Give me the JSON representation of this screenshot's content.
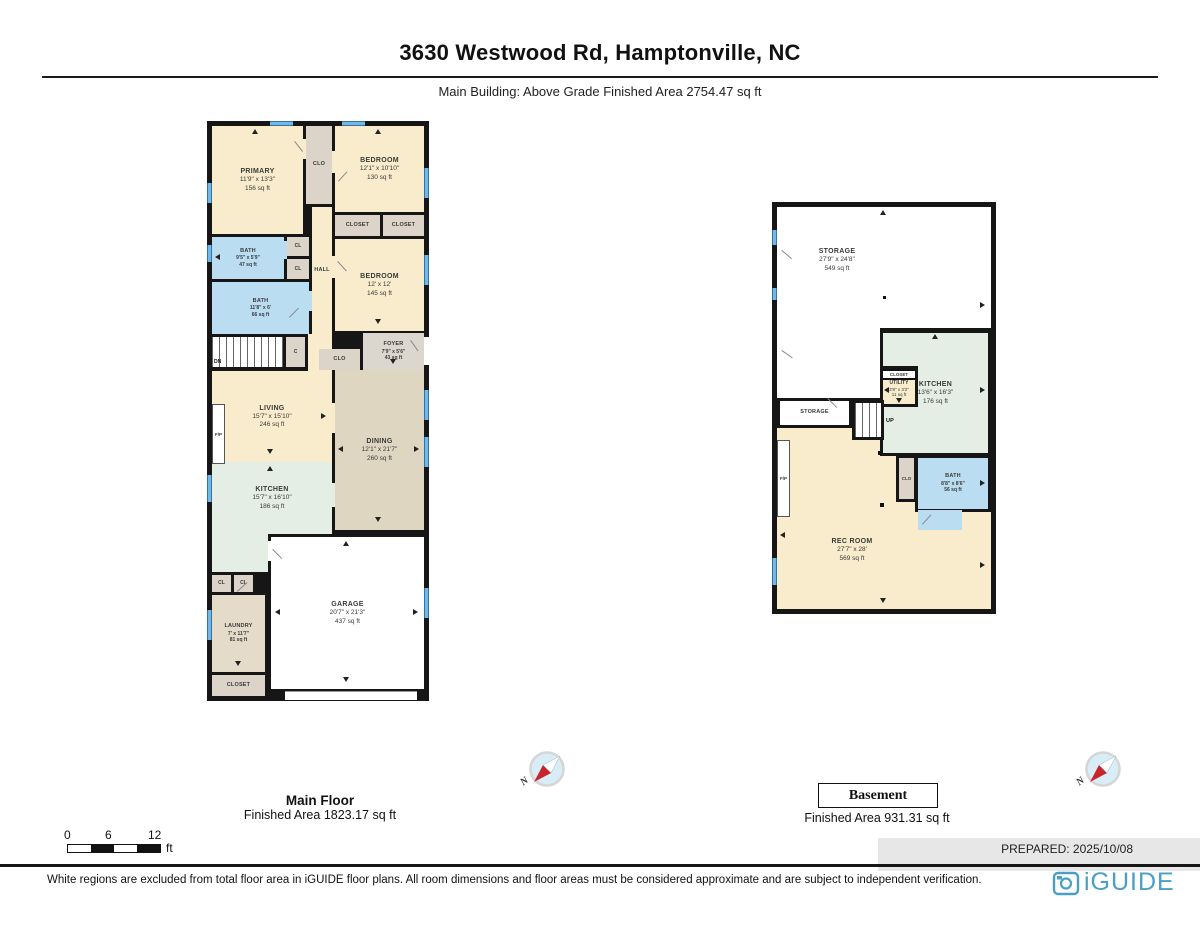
{
  "page": {
    "title": "3630 Westwood Rd, Hamptonville, NC",
    "subtitle": "Main Building: Above Grade Finished Area 2754.47 sq ft",
    "prepared": "PREPARED: 2025/10/08",
    "disclaimer": "White regions are excluded from total floor area in iGUIDE floor plans. All room dimensions and floor areas must be considered approximate and are subject to independent verification.",
    "brand": "iGUIDE"
  },
  "scale_bar": {
    "start": "0",
    "mid": "6",
    "end": "12",
    "unit": "ft"
  },
  "compass": {
    "north": "N"
  },
  "main_floor": {
    "title": "Main Floor",
    "area": "Finished Area 1823.17 sq ft",
    "rooms": {
      "primary": {
        "name": "PRIMARY",
        "dims": "11'9\" x 13'3\"",
        "area": "156 sq ft"
      },
      "clo_top": {
        "name": "CLO"
      },
      "bedroom1": {
        "name": "BEDROOM",
        "dims": "12'1\" x 10'10\"",
        "area": "130 sq ft"
      },
      "closet_left": {
        "name": "CLOSET"
      },
      "closet_right": {
        "name": "CLOSET"
      },
      "bath1": {
        "name": "BATH",
        "dims": "9'5\" x 5'9\"",
        "area": "47 sq ft"
      },
      "cl_a": {
        "name": "CL"
      },
      "cl_b": {
        "name": "CL"
      },
      "bath2": {
        "name": "BATH",
        "dims": "11'8\" x 6'",
        "area": "66 sq ft"
      },
      "hall": {
        "name": "HALL"
      },
      "bedroom2": {
        "name": "BEDROOM",
        "dims": "12' x 12'",
        "area": "145 sq ft"
      },
      "stairs": {
        "label": "DN"
      },
      "c_closet": {
        "name": "C"
      },
      "clo2": {
        "name": "CLO"
      },
      "foyer": {
        "name": "FOYER",
        "dims": "7'9\" x 5'6\"",
        "area": "43 sq ft"
      },
      "living": {
        "name": "LIVING",
        "dims": "15'7\" x 15'10\"",
        "area": "246 sq ft"
      },
      "fireplace": {
        "name": "F/P"
      },
      "dining": {
        "name": "DINING",
        "dims": "12'1\" x 21'7\"",
        "area": "260 sq ft"
      },
      "kitchen": {
        "name": "KITCHEN",
        "dims": "15'7\" x 16'10\"",
        "area": "186 sq ft"
      },
      "garage": {
        "name": "GARAGE",
        "dims": "20'7\" x 21'3\"",
        "area": "437 sq ft"
      },
      "cl_c": {
        "name": "CL"
      },
      "cl_d": {
        "name": "CL"
      },
      "laundry": {
        "name": "LAUNDRY",
        "dims": "7' x 11'7\"",
        "area": "81 sq ft"
      },
      "closet_bottom": {
        "name": "CLOSET"
      }
    }
  },
  "basement": {
    "title": "Basement",
    "area": "Finished Area 931.31 sq ft",
    "rooms": {
      "storage": {
        "name": "STORAGE",
        "dims": "27'9\" x 24'8\"",
        "area": "549 sq ft"
      },
      "storage_small": {
        "name": "STORAGE"
      },
      "stairs": {
        "label": "UP"
      },
      "kitchen": {
        "name": "KITCHEN",
        "dims": "13'6\" x 16'3\"",
        "area": "176 sq ft"
      },
      "utility": {
        "name": "UTILITY",
        "dims": "3'8\" x 3'2\"",
        "area": "11 sq ft",
        "closet": "CLOSET"
      },
      "rec_room": {
        "name": "REC ROOM",
        "dims": "27'7\" x 28'",
        "area": "569 sq ft"
      },
      "bath": {
        "name": "BATH",
        "dims": "8'8\" x 8'6\"",
        "area": "56 sq ft"
      },
      "clo": {
        "name": "CLO"
      },
      "fireplace": {
        "name": "F/P"
      }
    }
  }
}
